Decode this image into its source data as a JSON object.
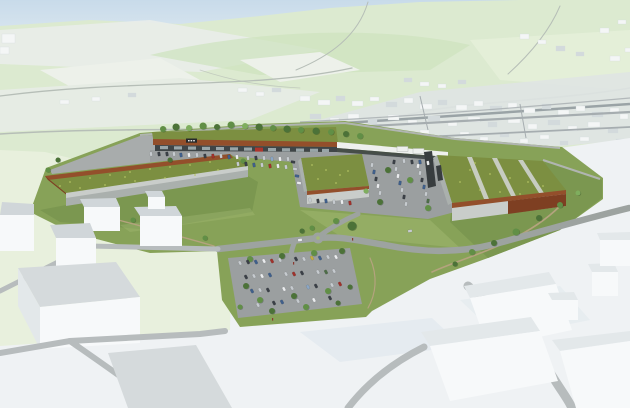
{
  "meta": {
    "kind": "architectural-aerial-render",
    "description": "Aerial 3D architectural visualization of a planned retail park with extensive green meadow roofs, corten steel facades, tree-lined car parks and a curving access road; background is a white massing model of the existing town on pale green hills, foreground is white massing blocks with grey roads."
  },
  "palette": {
    "sky_top": "#c8dbea",
    "sky_bottom": "#e9f0f4",
    "hills": "#dcead0",
    "hill_shade": "#cde3bd",
    "hills_light": "#e4efd8",
    "field_pale": "#edf1ea",
    "distant_white": "#e9ede9",
    "pale_left": "#e6ece4",
    "bg_road": "#b6beb7",
    "town_base": "#dfe4e3",
    "town_block": "#f4f6f6",
    "town_block2": "#d3dadc",
    "town_road": "#a6adb0",
    "town_dark_line": "#9aa3a6",
    "fg_green": "#e8f0dd",
    "fg_white": "#eff2f4",
    "site_grass": "#87a258",
    "slope_grass": "#7b9750",
    "grass_light": "#a3ba74",
    "site_road": "#9da3a0",
    "asphalt": "#9b9fa0",
    "asphalt2": "#a8acac",
    "green_roof": "#7c8f41",
    "green_roof_light": "#b6c464",
    "roof_stripe": "#c7ccc1",
    "corten": "#934f2b",
    "corten2": "#7e3f22",
    "concrete": "#c9cdca",
    "concrete_dark": "#aab0ad",
    "wall_light": "#b0b5b1",
    "storefront": "#3f4547",
    "glass": "#a9b6ba",
    "sign_dark": "#26292b",
    "sign_red": "#ae352c",
    "canopy": "#eef0ee",
    "slab_dark": "#383d3f",
    "path_dirt": "#b4a37e",
    "massing_white": "#f7f9fa",
    "massing_top": "#d0d6d9",
    "massing_side": "#e3e8ea",
    "massing_shadow": "#dde5ec",
    "fg_road": "#b7bcbd",
    "fg_roof": "#d5dadc",
    "t1": "#4c7238",
    "t2": "#618f46",
    "t3": "#7fae5e",
    "car_silver": "#c6cbcf",
    "car_white": "#eaecee",
    "car_dark": "#3b4047",
    "car_blue": "#40608c",
    "car_red": "#a0322c",
    "car_green": "#4e6e48",
    "car_yellow": "#c4ae43",
    "car_sky": "#8ba7c6",
    "figure": "#8a3a30"
  },
  "scene": {
    "site": {
      "buildings": [
        {
          "name": "left-retail-hall",
          "roof": "extensive green meadow roof",
          "facade": "corten band and grey concrete"
        },
        {
          "name": "north-retail-strip",
          "roof": "green roof with tree row",
          "facade": "corten fascia over glazed storefronts, dark illegible fascia sign, one red shop unit"
        },
        {
          "name": "middle-retail-hall",
          "roof": "extensive green roof",
          "facade": "corten parapet and grey concrete"
        },
        {
          "name": "right-retail-hall",
          "roof": "green roof with three grey skylight strips",
          "facade": "corten and grey concrete, dark entrance"
        }
      ],
      "sign_text": ""
    },
    "town_blocks": [
      [
        520,
        34,
        9,
        5
      ],
      [
        538,
        40,
        8,
        4
      ],
      [
        556,
        46,
        9,
        5
      ],
      [
        600,
        28,
        9,
        5
      ],
      [
        618,
        20,
        8,
        4
      ],
      [
        576,
        52,
        8,
        4
      ],
      [
        610,
        56,
        10,
        5
      ],
      [
        625,
        48,
        6,
        4
      ],
      [
        404,
        78,
        8,
        4
      ],
      [
        420,
        82,
        9,
        4
      ],
      [
        438,
        84,
        8,
        4
      ],
      [
        458,
        80,
        8,
        4
      ],
      [
        300,
        96,
        10,
        5
      ],
      [
        318,
        100,
        12,
        5
      ],
      [
        336,
        96,
        9,
        5
      ],
      [
        352,
        101,
        11,
        5
      ],
      [
        370,
        97,
        9,
        4
      ],
      [
        386,
        102,
        11,
        5
      ],
      [
        404,
        98,
        9,
        5
      ],
      [
        420,
        104,
        12,
        5
      ],
      [
        438,
        100,
        9,
        5
      ],
      [
        456,
        105,
        11,
        5
      ],
      [
        474,
        101,
        9,
        5
      ],
      [
        490,
        106,
        12,
        5
      ],
      [
        508,
        103,
        9,
        5
      ],
      [
        524,
        108,
        11,
        5
      ],
      [
        542,
        104,
        9,
        5
      ],
      [
        558,
        110,
        11,
        5
      ],
      [
        576,
        106,
        9,
        5
      ],
      [
        592,
        112,
        11,
        5
      ],
      [
        610,
        108,
        9,
        5
      ],
      [
        620,
        114,
        8,
        5
      ],
      [
        310,
        114,
        11,
        5
      ],
      [
        330,
        118,
        9,
        5
      ],
      [
        348,
        114,
        11,
        5
      ],
      [
        368,
        119,
        9,
        5
      ],
      [
        388,
        115,
        11,
        5
      ],
      [
        408,
        120,
        9,
        5
      ],
      [
        428,
        116,
        12,
        5
      ],
      [
        448,
        121,
        9,
        5
      ],
      [
        468,
        117,
        12,
        5
      ],
      [
        488,
        122,
        9,
        5
      ],
      [
        508,
        118,
        12,
        5
      ],
      [
        528,
        124,
        9,
        5
      ],
      [
        548,
        120,
        12,
        5
      ],
      [
        568,
        126,
        9,
        5
      ],
      [
        588,
        122,
        12,
        5
      ],
      [
        608,
        128,
        10,
        5
      ],
      [
        340,
        128,
        9,
        4
      ],
      [
        360,
        132,
        8,
        4
      ],
      [
        380,
        129,
        9,
        4
      ],
      [
        400,
        134,
        8,
        4
      ],
      [
        420,
        130,
        9,
        4
      ],
      [
        440,
        135,
        8,
        4
      ],
      [
        460,
        132,
        9,
        4
      ],
      [
        480,
        137,
        8,
        4
      ],
      [
        500,
        133,
        9,
        4
      ],
      [
        520,
        139,
        8,
        4
      ],
      [
        540,
        135,
        9,
        4
      ],
      [
        560,
        141,
        8,
        4
      ],
      [
        580,
        137,
        9,
        4
      ],
      [
        600,
        143,
        9,
        4
      ],
      [
        616,
        139,
        8,
        4
      ],
      [
        238,
        88,
        9,
        4
      ],
      [
        256,
        92,
        8,
        4
      ],
      [
        272,
        88,
        9,
        4
      ],
      [
        60,
        100,
        9,
        4
      ],
      [
        92,
        97,
        8,
        4
      ],
      [
        128,
        93,
        8,
        4
      ],
      [
        2,
        34,
        13,
        9
      ],
      [
        0,
        47,
        9,
        7
      ]
    ],
    "trees": [
      [
        163,
        129,
        3,
        "t2"
      ],
      [
        176,
        127,
        3.5,
        "t1"
      ],
      [
        189,
        128,
        3,
        "t3"
      ],
      [
        203,
        126,
        3.5,
        "t2"
      ],
      [
        217,
        127,
        3,
        "t1"
      ],
      [
        231,
        125,
        3.5,
        "t2"
      ],
      [
        245,
        126,
        3,
        "t3"
      ],
      [
        259,
        127,
        3.5,
        "t1"
      ],
      [
        273,
        128,
        3,
        "t2"
      ],
      [
        287,
        129,
        3.5,
        "t1"
      ],
      [
        301,
        130,
        3,
        "t2"
      ],
      [
        316,
        131,
        3.5,
        "t1"
      ],
      [
        331,
        132,
        3,
        "t2"
      ],
      [
        346,
        134,
        3,
        "t1"
      ],
      [
        360,
        136,
        3,
        "t2"
      ],
      [
        58,
        160,
        2.5,
        "t1"
      ],
      [
        48,
        170,
        2.5,
        "t2"
      ],
      [
        243,
        161,
        2.5,
        "t2"
      ],
      [
        170,
        160,
        2.5,
        "t1"
      ],
      [
        388,
        170,
        3,
        "t1"
      ],
      [
        410,
        180,
        3,
        "t2"
      ],
      [
        380,
        202,
        3,
        "t1"
      ],
      [
        428,
        208,
        3,
        "t2"
      ],
      [
        366,
        191,
        2.5,
        "t3"
      ],
      [
        472,
        252,
        3,
        "t2"
      ],
      [
        494,
        243,
        3,
        "t1"
      ],
      [
        516,
        232,
        3.5,
        "t2"
      ],
      [
        539,
        218,
        3,
        "t1"
      ],
      [
        560,
        205,
        3,
        "t2"
      ],
      [
        578,
        193,
        2.5,
        "t3"
      ],
      [
        455,
        264,
        2.5,
        "t1"
      ],
      [
        352,
        226,
        4.5,
        "t1"
      ],
      [
        336,
        221,
        3,
        "t2"
      ],
      [
        312,
        228,
        2.5,
        "t2"
      ],
      [
        302,
        231,
        2.5,
        "t1"
      ],
      [
        97,
        213,
        2.5,
        "t1"
      ],
      [
        133,
        220,
        2.5,
        "t2"
      ],
      [
        170,
        229,
        2.5,
        "t1"
      ],
      [
        205,
        238,
        2.5,
        "t2"
      ],
      [
        250,
        259,
        3,
        "t2"
      ],
      [
        282,
        256,
        3,
        "t1"
      ],
      [
        314,
        253,
        3,
        "t2"
      ],
      [
        342,
        251,
        3,
        "t1"
      ],
      [
        246,
        286,
        3,
        "t1"
      ],
      [
        260,
        300,
        3,
        "t2"
      ],
      [
        294,
        296,
        3,
        "t1"
      ],
      [
        328,
        291,
        3,
        "t2"
      ],
      [
        350,
        287,
        2.5,
        "t1"
      ],
      [
        240,
        307,
        2.5,
        "t2"
      ],
      [
        272,
        311,
        3,
        "t1"
      ],
      [
        306,
        307,
        3,
        "t2"
      ],
      [
        338,
        303,
        2.5,
        "t1"
      ]
    ],
    "cars": [
      [
        151,
        154,
        80,
        "silver"
      ],
      [
        159,
        154,
        80,
        "dark"
      ],
      [
        167,
        154,
        80,
        "dark"
      ],
      [
        174,
        154,
        80,
        "silver"
      ],
      [
        181,
        155,
        80,
        "blue"
      ],
      [
        189,
        155,
        80,
        "white"
      ],
      [
        197,
        155,
        80,
        "silver"
      ],
      [
        205,
        156,
        80,
        "dark"
      ],
      [
        213,
        156,
        80,
        "red"
      ],
      [
        221,
        156,
        80,
        "silver"
      ],
      [
        229,
        157,
        80,
        "blue"
      ],
      [
        237,
        157,
        80,
        "white"
      ],
      [
        248,
        158,
        80,
        "silver"
      ],
      [
        256,
        158,
        80,
        "dark"
      ],
      [
        264,
        158,
        80,
        "silver"
      ],
      [
        272,
        159,
        80,
        "sky"
      ],
      [
        280,
        159,
        80,
        "white"
      ],
      [
        288,
        159,
        80,
        "silver"
      ],
      [
        238,
        164,
        80,
        "silver"
      ],
      [
        246,
        164,
        80,
        "dark"
      ],
      [
        254,
        165,
        80,
        "blue"
      ],
      [
        262,
        165,
        80,
        "silver"
      ],
      [
        270,
        166,
        80,
        "red"
      ],
      [
        278,
        166,
        80,
        "white"
      ],
      [
        286,
        167,
        80,
        "silver"
      ],
      [
        293,
        162,
        10,
        "dark"
      ],
      [
        295,
        169,
        10,
        "silver"
      ],
      [
        297,
        176,
        10,
        "blue"
      ],
      [
        299,
        183,
        10,
        "white"
      ],
      [
        310,
        200,
        80,
        "silver"
      ],
      [
        318,
        201,
        80,
        "dark"
      ],
      [
        326,
        201,
        80,
        "blue"
      ],
      [
        334,
        202,
        80,
        "silver"
      ],
      [
        342,
        202,
        80,
        "white"
      ],
      [
        350,
        203,
        80,
        "red"
      ],
      [
        404,
        161,
        80,
        "silver"
      ],
      [
        412,
        162,
        80,
        "dark"
      ],
      [
        420,
        162,
        80,
        "blue"
      ],
      [
        428,
        163,
        80,
        "white"
      ],
      [
        372,
        165,
        100,
        "silver"
      ],
      [
        374,
        172,
        100,
        "blue"
      ],
      [
        376,
        179,
        100,
        "dark"
      ],
      [
        378,
        186,
        100,
        "white"
      ],
      [
        380,
        193,
        100,
        "silver"
      ],
      [
        394,
        162,
        100,
        "dark"
      ],
      [
        396,
        169,
        100,
        "silver"
      ],
      [
        398,
        176,
        100,
        "white"
      ],
      [
        400,
        183,
        100,
        "blue"
      ],
      [
        402,
        190,
        100,
        "silver"
      ],
      [
        404,
        197,
        100,
        "dark"
      ],
      [
        406,
        204,
        100,
        "silver"
      ],
      [
        418,
        166,
        100,
        "white"
      ],
      [
        420,
        173,
        100,
        "silver"
      ],
      [
        422,
        180,
        100,
        "dark"
      ],
      [
        424,
        187,
        100,
        "blue"
      ],
      [
        426,
        194,
        100,
        "silver"
      ],
      [
        428,
        201,
        100,
        "green"
      ],
      [
        300,
        240,
        -6,
        "white"
      ],
      [
        410,
        231,
        -10,
        "silver"
      ],
      [
        240,
        263,
        62,
        "silver"
      ],
      [
        248,
        262,
        62,
        "dark"
      ],
      [
        256,
        262,
        62,
        "blue"
      ],
      [
        264,
        261,
        62,
        "white"
      ],
      [
        272,
        261,
        62,
        "red"
      ],
      [
        280,
        260,
        62,
        "silver"
      ],
      [
        296,
        259,
        62,
        "dark"
      ],
      [
        304,
        259,
        62,
        "silver"
      ],
      [
        312,
        258,
        62,
        "yellow"
      ],
      [
        320,
        258,
        62,
        "blue"
      ],
      [
        328,
        257,
        62,
        "silver"
      ],
      [
        336,
        257,
        62,
        "white"
      ],
      [
        246,
        277,
        62,
        "dark"
      ],
      [
        254,
        276,
        62,
        "silver"
      ],
      [
        262,
        276,
        62,
        "white"
      ],
      [
        270,
        275,
        62,
        "blue"
      ],
      [
        286,
        274,
        62,
        "silver"
      ],
      [
        294,
        274,
        62,
        "red"
      ],
      [
        302,
        273,
        62,
        "dark"
      ],
      [
        318,
        272,
        62,
        "silver"
      ],
      [
        326,
        272,
        62,
        "green"
      ],
      [
        334,
        271,
        62,
        "silver"
      ],
      [
        252,
        291,
        62,
        "blue"
      ],
      [
        260,
        290,
        62,
        "silver"
      ],
      [
        268,
        290,
        62,
        "dark"
      ],
      [
        284,
        289,
        62,
        "white"
      ],
      [
        292,
        288,
        62,
        "silver"
      ],
      [
        308,
        287,
        62,
        "sky"
      ],
      [
        316,
        286,
        62,
        "dark"
      ],
      [
        332,
        285,
        62,
        "silver"
      ],
      [
        340,
        284,
        62,
        "red"
      ],
      [
        258,
        305,
        62,
        "silver"
      ],
      [
        274,
        303,
        62,
        "dark"
      ],
      [
        282,
        302,
        62,
        "blue"
      ],
      [
        298,
        301,
        62,
        "silver"
      ],
      [
        314,
        300,
        62,
        "white"
      ],
      [
        330,
        298,
        62,
        "dark"
      ]
    ],
    "roof_dots": [
      [
        70,
        182
      ],
      [
        90,
        178
      ],
      [
        110,
        175
      ],
      [
        130,
        172
      ],
      [
        150,
        169
      ],
      [
        170,
        167
      ],
      [
        190,
        165
      ],
      [
        210,
        162
      ],
      [
        80,
        188
      ],
      [
        105,
        185
      ],
      [
        135,
        181
      ],
      [
        165,
        178
      ],
      [
        195,
        175
      ],
      [
        218,
        170
      ],
      [
        60,
        186
      ],
      [
        125,
        177
      ],
      [
        470,
        170
      ],
      [
        490,
        174
      ],
      [
        510,
        178
      ],
      [
        528,
        182
      ],
      [
        480,
        190
      ],
      [
        500,
        192
      ],
      [
        520,
        194
      ],
      [
        460,
        182
      ],
      [
        543,
        186
      ],
      [
        475,
        163
      ],
      [
        312,
        165
      ],
      [
        326,
        170
      ],
      [
        340,
        175
      ],
      [
        318,
        179
      ],
      [
        336,
        183
      ],
      [
        348,
        171
      ]
    ],
    "figures": [
      [
        352,
        238
      ],
      [
        293,
        262
      ],
      [
        272,
        318
      ]
    ]
  }
}
